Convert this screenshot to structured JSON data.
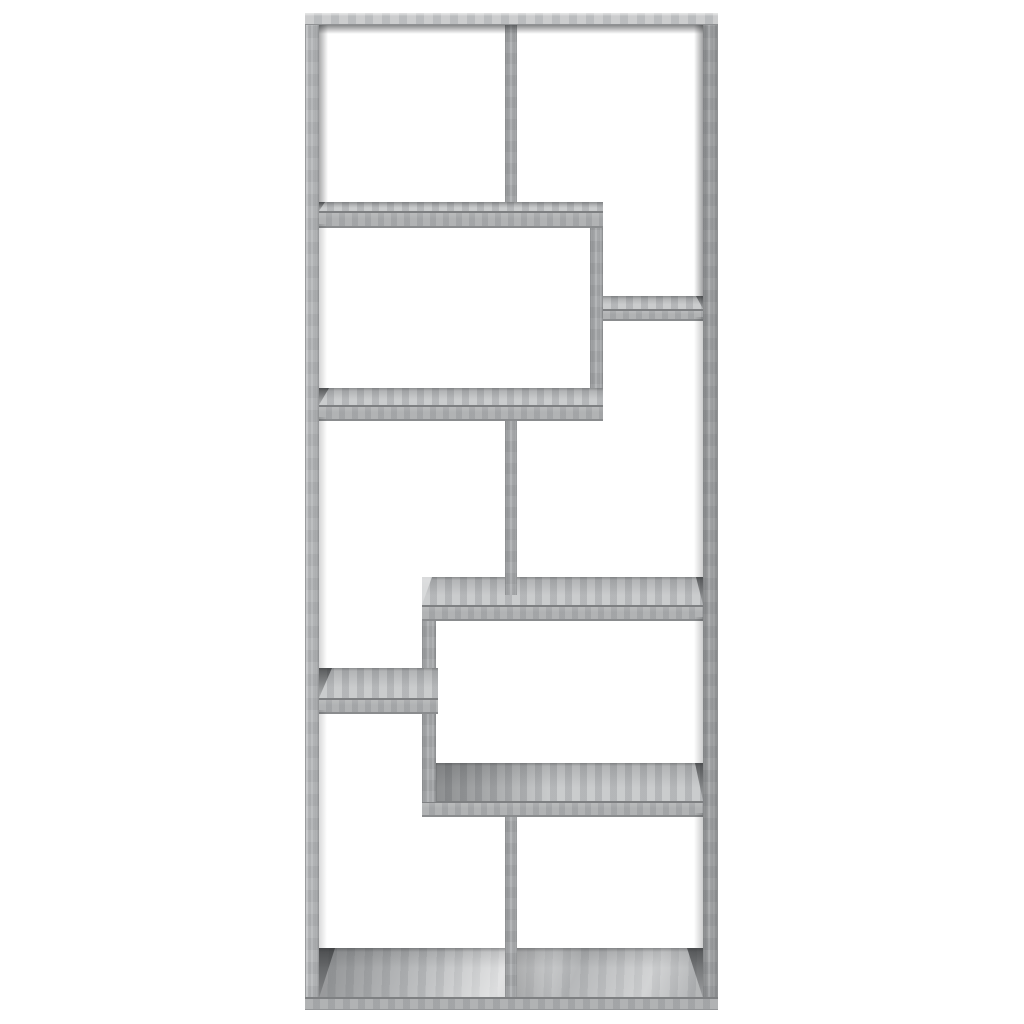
{
  "image": {
    "type": "product-photo",
    "subject": "Geometric open bookcase / room divider with 8 asymmetric compartments, grey sonoma oak finish, front view on plain white background",
    "width_px": 1024,
    "height_px": 1024
  },
  "palette": {
    "background": "#ffffff",
    "wood_face": "#a8aaac",
    "wood_face_light": "#b3b5b7",
    "wood_surface": "#bdbfc1",
    "wood_surface_bright": "#cfd1d2",
    "wood_edge": "#7e8082",
    "frame_top_surface": "#c2c4c5",
    "frame_right_face": "#a4a6a8",
    "shadow": "#55575a"
  },
  "bookcase": {
    "outer": {
      "x": 305,
      "y": 13,
      "width": 413,
      "height": 997
    },
    "boards": [
      {
        "name": "bottom-floor-panel",
        "kind": "floor",
        "x": 319,
        "y": 948,
        "w": 384,
        "h": 50,
        "surface_h": 50,
        "wedge_l": {
          "w": 16,
          "tone": "dark"
        },
        "wedge_r": {
          "w": 16,
          "tone": "dark"
        }
      },
      {
        "name": "bottom-center-divider",
        "kind": "v",
        "x": 505,
        "y": 801,
        "w": 12,
        "h": 196
      },
      {
        "name": "lower-protruding-shelf",
        "kind": "shelf",
        "x": 422,
        "y": 763,
        "w": 281,
        "h": 50,
        "surface_h": 38,
        "lshade": true,
        "wedge_l": {
          "w": 8,
          "tone": "light"
        },
        "wedge_r": {
          "w": 8,
          "tone": "dark"
        }
      },
      {
        "name": "lower-left-riser",
        "kind": "v",
        "x": 422,
        "y": 610,
        "w": 14,
        "h": 192
      },
      {
        "name": "middle-protruding-shelf",
        "kind": "shelf",
        "x": 422,
        "y": 577,
        "w": 281,
        "h": 40,
        "surface_h": 28,
        "wedge_l": {
          "w": 10,
          "tone": "light"
        },
        "wedge_r": {
          "w": 7,
          "tone": "dark"
        }
      },
      {
        "name": "middle-center-divider",
        "kind": "v",
        "x": 505,
        "y": 405,
        "w": 12,
        "h": 190
      },
      {
        "name": "upper-right-riser",
        "kind": "v",
        "x": 590,
        "y": 202,
        "w": 13,
        "h": 215
      },
      {
        "name": "large-middle-shelf",
        "kind": "shelf",
        "x": 319,
        "y": 388,
        "w": 284,
        "h": 29,
        "surface_h": 17,
        "wedge_l": {
          "w": 10,
          "tone": "dark"
        }
      },
      {
        "name": "small-right-shelf",
        "kind": "shelf",
        "x": 603,
        "y": 296,
        "w": 100,
        "h": 21,
        "surface_h": 13,
        "wedge_r": {
          "w": 7,
          "tone": "dark"
        }
      },
      {
        "name": "top-center-divider",
        "kind": "v",
        "x": 505,
        "y": 25,
        "w": 12,
        "h": 182
      },
      {
        "name": "upper-left-shelf",
        "kind": "shelf",
        "x": 319,
        "y": 202,
        "w": 284,
        "h": 22,
        "surface_h": 9,
        "wedge_l": {
          "w": 6,
          "tone": "dark"
        }
      },
      {
        "name": "small-left-shelf",
        "kind": "shelf",
        "x": 319,
        "y": 668,
        "w": 119,
        "h": 42,
        "surface_h": 30,
        "wedge_l": {
          "w": 13,
          "tone": "dark"
        }
      },
      {
        "name": "frame-left-side",
        "kind": "frame-left",
        "x": 305,
        "y": 13,
        "w": 14,
        "h": 997
      },
      {
        "name": "frame-right-side",
        "kind": "frame-right",
        "x": 703,
        "y": 13,
        "w": 15,
        "h": 997
      },
      {
        "name": "frame-top-board",
        "kind": "frame-top",
        "x": 305,
        "y": 13,
        "w": 413,
        "h": 12
      },
      {
        "name": "frame-bottom-board",
        "kind": "frame-bottom",
        "x": 305,
        "y": 997,
        "w": 413,
        "h": 13
      },
      {
        "name": "inner-shadow-under-top",
        "kind": "shadow-v",
        "x": 319,
        "y": 25,
        "w": 384,
        "h": 9,
        "op": 0.65
      },
      {
        "name": "inner-shadow-left-top",
        "kind": "shadow-hl",
        "x": 319,
        "y": 25,
        "w": 9,
        "h": 177,
        "op": 0.5
      },
      {
        "name": "inner-shadow-right-top",
        "kind": "shadow-hr",
        "x": 694,
        "y": 25,
        "w": 9,
        "h": 271,
        "op": 0.55
      },
      {
        "name": "inner-shadow-right-mid",
        "kind": "shadow-hr",
        "x": 694,
        "y": 317,
        "w": 9,
        "h": 260,
        "op": 0.3
      },
      {
        "name": "inner-shadow-right-low",
        "kind": "shadow-hr",
        "x": 694,
        "y": 617,
        "w": 9,
        "h": 146,
        "op": 0.3
      },
      {
        "name": "inner-shadow-right-bottom",
        "kind": "shadow-hr",
        "x": 694,
        "y": 813,
        "w": 9,
        "h": 135,
        "op": 0.3
      },
      {
        "name": "inner-shadow-left-mid",
        "kind": "shadow-hl",
        "x": 319,
        "y": 224,
        "w": 8,
        "h": 164,
        "op": 0.25
      },
      {
        "name": "inner-shadow-left-low",
        "kind": "shadow-hl",
        "x": 319,
        "y": 417,
        "w": 8,
        "h": 251,
        "op": 0.25
      },
      {
        "name": "inner-shadow-left-bottom",
        "kind": "shadow-hl",
        "x": 319,
        "y": 710,
        "w": 8,
        "h": 238,
        "op": 0.22
      },
      {
        "name": "divider-cast-shadow-floor",
        "kind": "shadow-hl",
        "x": 517,
        "y": 948,
        "w": 34,
        "h": 49,
        "op": 0.33
      }
    ]
  }
}
